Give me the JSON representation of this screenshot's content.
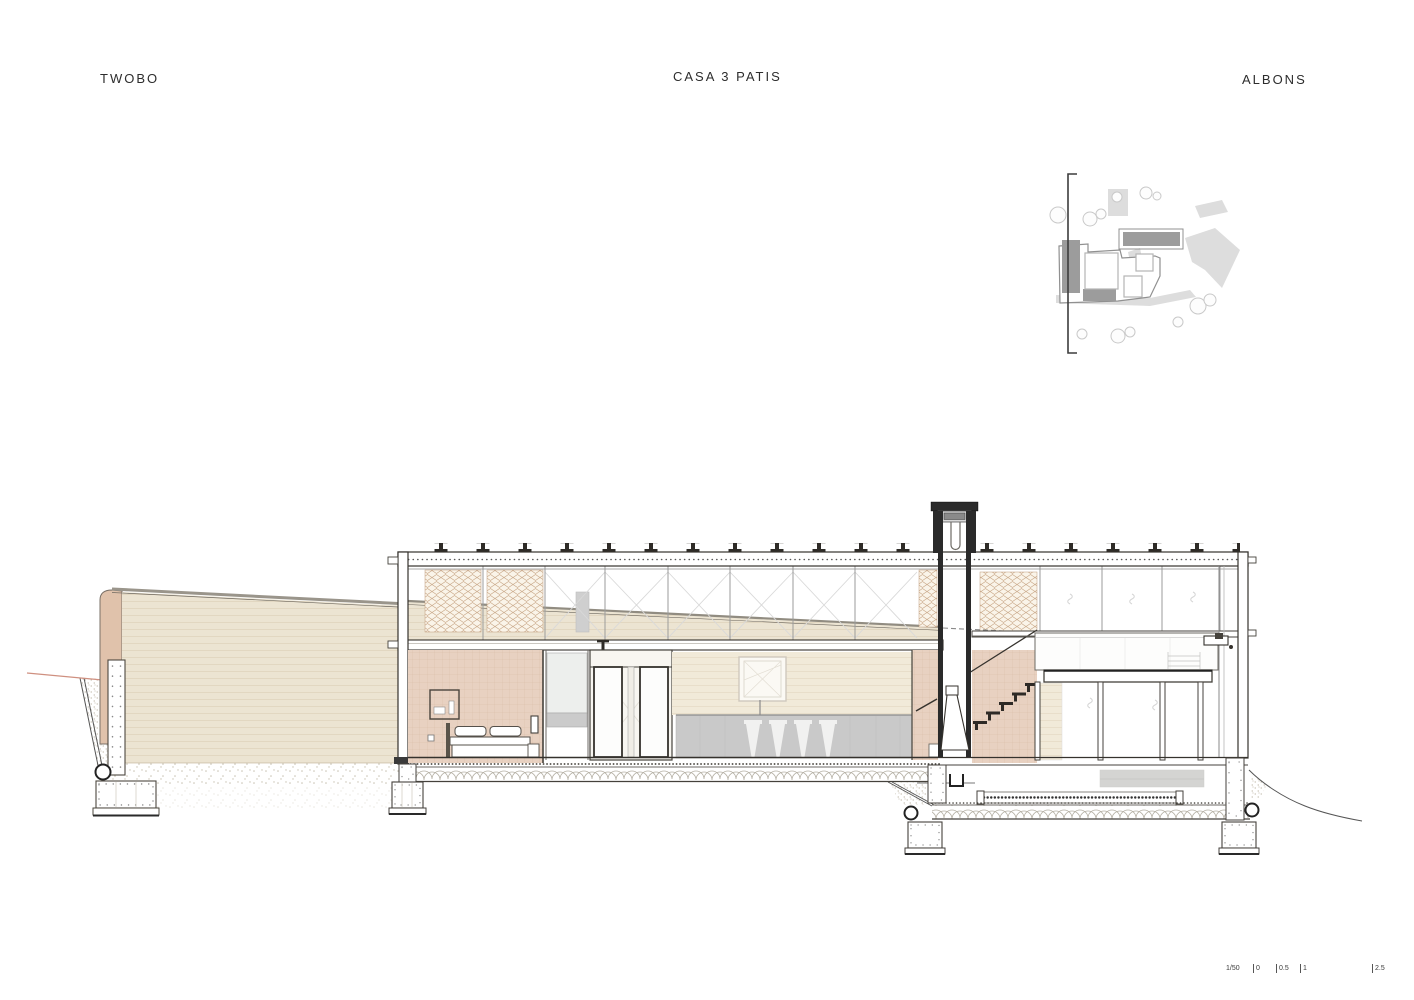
{
  "header": {
    "studio": "TWOBO",
    "project": "CASA 3 PATIS",
    "location": "ALBONS"
  },
  "scale_bar": {
    "ratio": "1/50",
    "ticks": [
      "0",
      "0.5",
      "1",
      "2.5"
    ]
  },
  "drawing": {
    "type": "architectural-cross-section",
    "elements": [
      "garden-wall",
      "clerestory-lattice",
      "bedroom",
      "double-doors",
      "kitchen-counter",
      "bar-stools",
      "fireplace-chimney",
      "stair",
      "suspended-volume",
      "sunken-level",
      "footings",
      "site-plan"
    ]
  },
  "colors": {
    "line_dark": "#2e2b27",
    "line_mid": "#8a867e",
    "wall_beige": "#ece4d2",
    "wall_line": "#ded2ba",
    "siding_bg": "#f1ead9",
    "siding_line": "#e4dac4",
    "tile_pink": "#e8d1c1",
    "tile_line": "#d9bba6",
    "tile_cap": "#e0c2ab",
    "lattice_tan": "#c9a888",
    "lattice_bg": "#faf4e9",
    "counter_gray": "#c9c9c9",
    "stool_white": "#f1f1f0",
    "terrain_red": "#cf9080",
    "stipple": "#c2bbaa",
    "scallop": "#b4afa3",
    "box_gray": "#d4d4d2",
    "plan_dark": "#9c9c9c",
    "plan_light": "#dddddd",
    "plan_outline": "#909090",
    "tree_line": "#c9c9c9"
  }
}
